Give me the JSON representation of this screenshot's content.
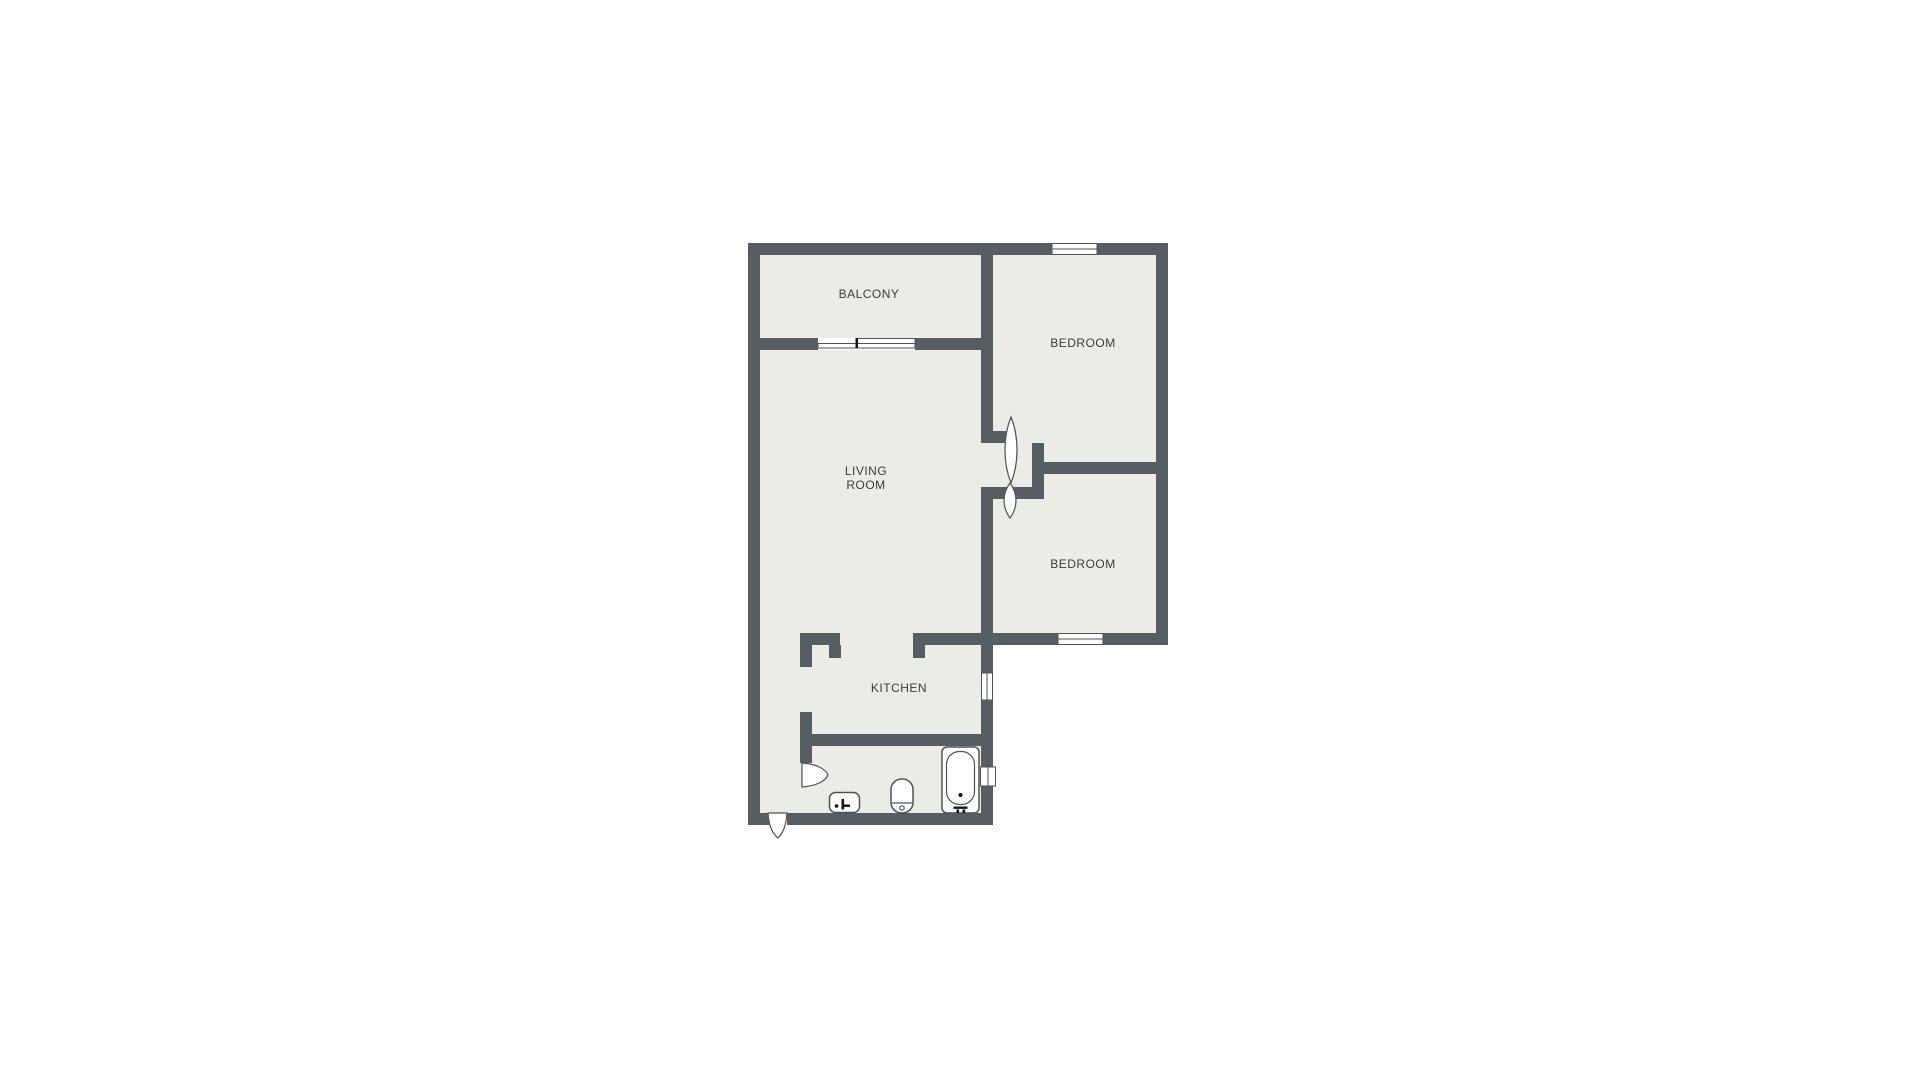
{
  "colors": {
    "background": "#ffffff",
    "wall": "#565d63",
    "floor": "#ebece6",
    "window_fill": "#ffffff",
    "outline": "#4d5357",
    "label_text": "#3a3b3c",
    "mark": "#141414"
  },
  "rooms": {
    "balcony": {
      "label": "BALCONY"
    },
    "bedroom_top": {
      "label": "BEDROOM"
    },
    "bedroom_bottom": {
      "label": "BEDROOM"
    },
    "living_room": {
      "label": "LIVING ROOM",
      "label_lines": [
        "LIVING",
        "ROOM"
      ]
    },
    "kitchen": {
      "label": "KITCHEN"
    }
  },
  "icons": {
    "bathtub": "bathtub-outline-shape",
    "toilet": "toilet-outline-shape",
    "sink": "sink-outline-shape",
    "door_swing": "door-leaf-petal",
    "sliding_door": "offset-double-rail",
    "window": "white-inset-pane"
  }
}
